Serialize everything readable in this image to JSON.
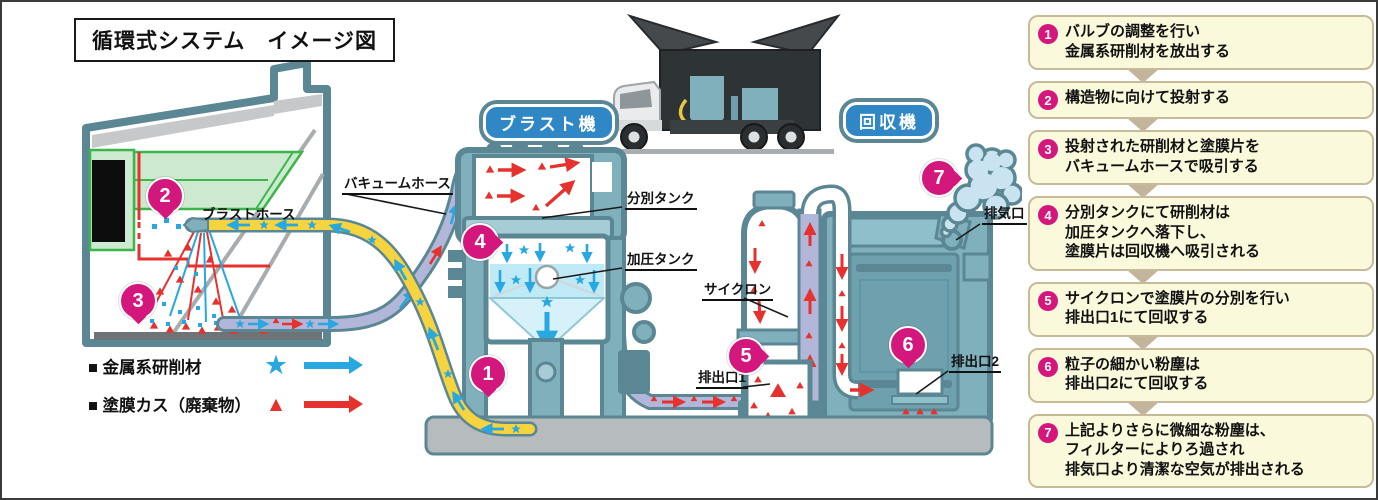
{
  "title": "循環式システム　イメージ図",
  "machine_labels": {
    "blast": "ブラスト機",
    "recovery": "回収機"
  },
  "part_labels": {
    "vacuum_hose": "バキュームホース",
    "blast_hose": "ブラストホース",
    "separation_tank": "分別タンク",
    "pressure_tank": "加圧タンク",
    "cyclone": "サイクロン",
    "outlet1": "排出口1",
    "outlet2": "排出口2",
    "exhaust": "排気口"
  },
  "legend": {
    "items": [
      {
        "label": "■ 金属系研削材",
        "marker": "star-icon",
        "arrow": "blue-arrow-icon",
        "color": "#29A7E0",
        "marker_glyph": "★"
      },
      {
        "label": "■ 塗膜カス（廃棄物）",
        "marker": "triangle-icon",
        "arrow": "red-arrow-icon",
        "color": "#E5322E",
        "marker_glyph": "▲"
      }
    ]
  },
  "badge_numbers": [
    "1",
    "2",
    "3",
    "4",
    "5",
    "6",
    "7"
  ],
  "steps": [
    {
      "num": "1",
      "text": "バルブの調整を行い\n金属系研削材を放出する"
    },
    {
      "num": "2",
      "text": "構造物に向けて投射する"
    },
    {
      "num": "3",
      "text": "投射された研削材と塗膜片を\nバキュームホースで吸引する"
    },
    {
      "num": "4",
      "text": "分別タンクにて研削材は\n加圧タンクへ落下し、\n塗膜片は回収機へ吸引される"
    },
    {
      "num": "5",
      "text": "サイクロンで塗膜片の分別を行い\n排出口1にて回収する"
    },
    {
      "num": "6",
      "text": "粒子の細かい粉塵は\n排出口2にて回収する"
    },
    {
      "num": "7",
      "text": "上記よりさらに微細な粉塵は、\nフィルターによりろ過され\n排気口より清潔な空気が排出される"
    }
  ],
  "colors": {
    "machine_outline": "#5B8794",
    "machine_fill": "#7FB0BC",
    "abrasive_blue": "#29A7E0",
    "waste_red": "#E5322E",
    "blast_hose_yellow": "#F6D43F",
    "vacuum_hose_lavender": "#B2B7DA",
    "badge_magenta": "#D4177C",
    "label_badge_blue": "#2F87C5",
    "step_box_cream": "#FBF9DC",
    "step_border_tan": "#C7BA98",
    "connector_tan": "#C3B59B",
    "structure_green": "#3CB54A"
  }
}
